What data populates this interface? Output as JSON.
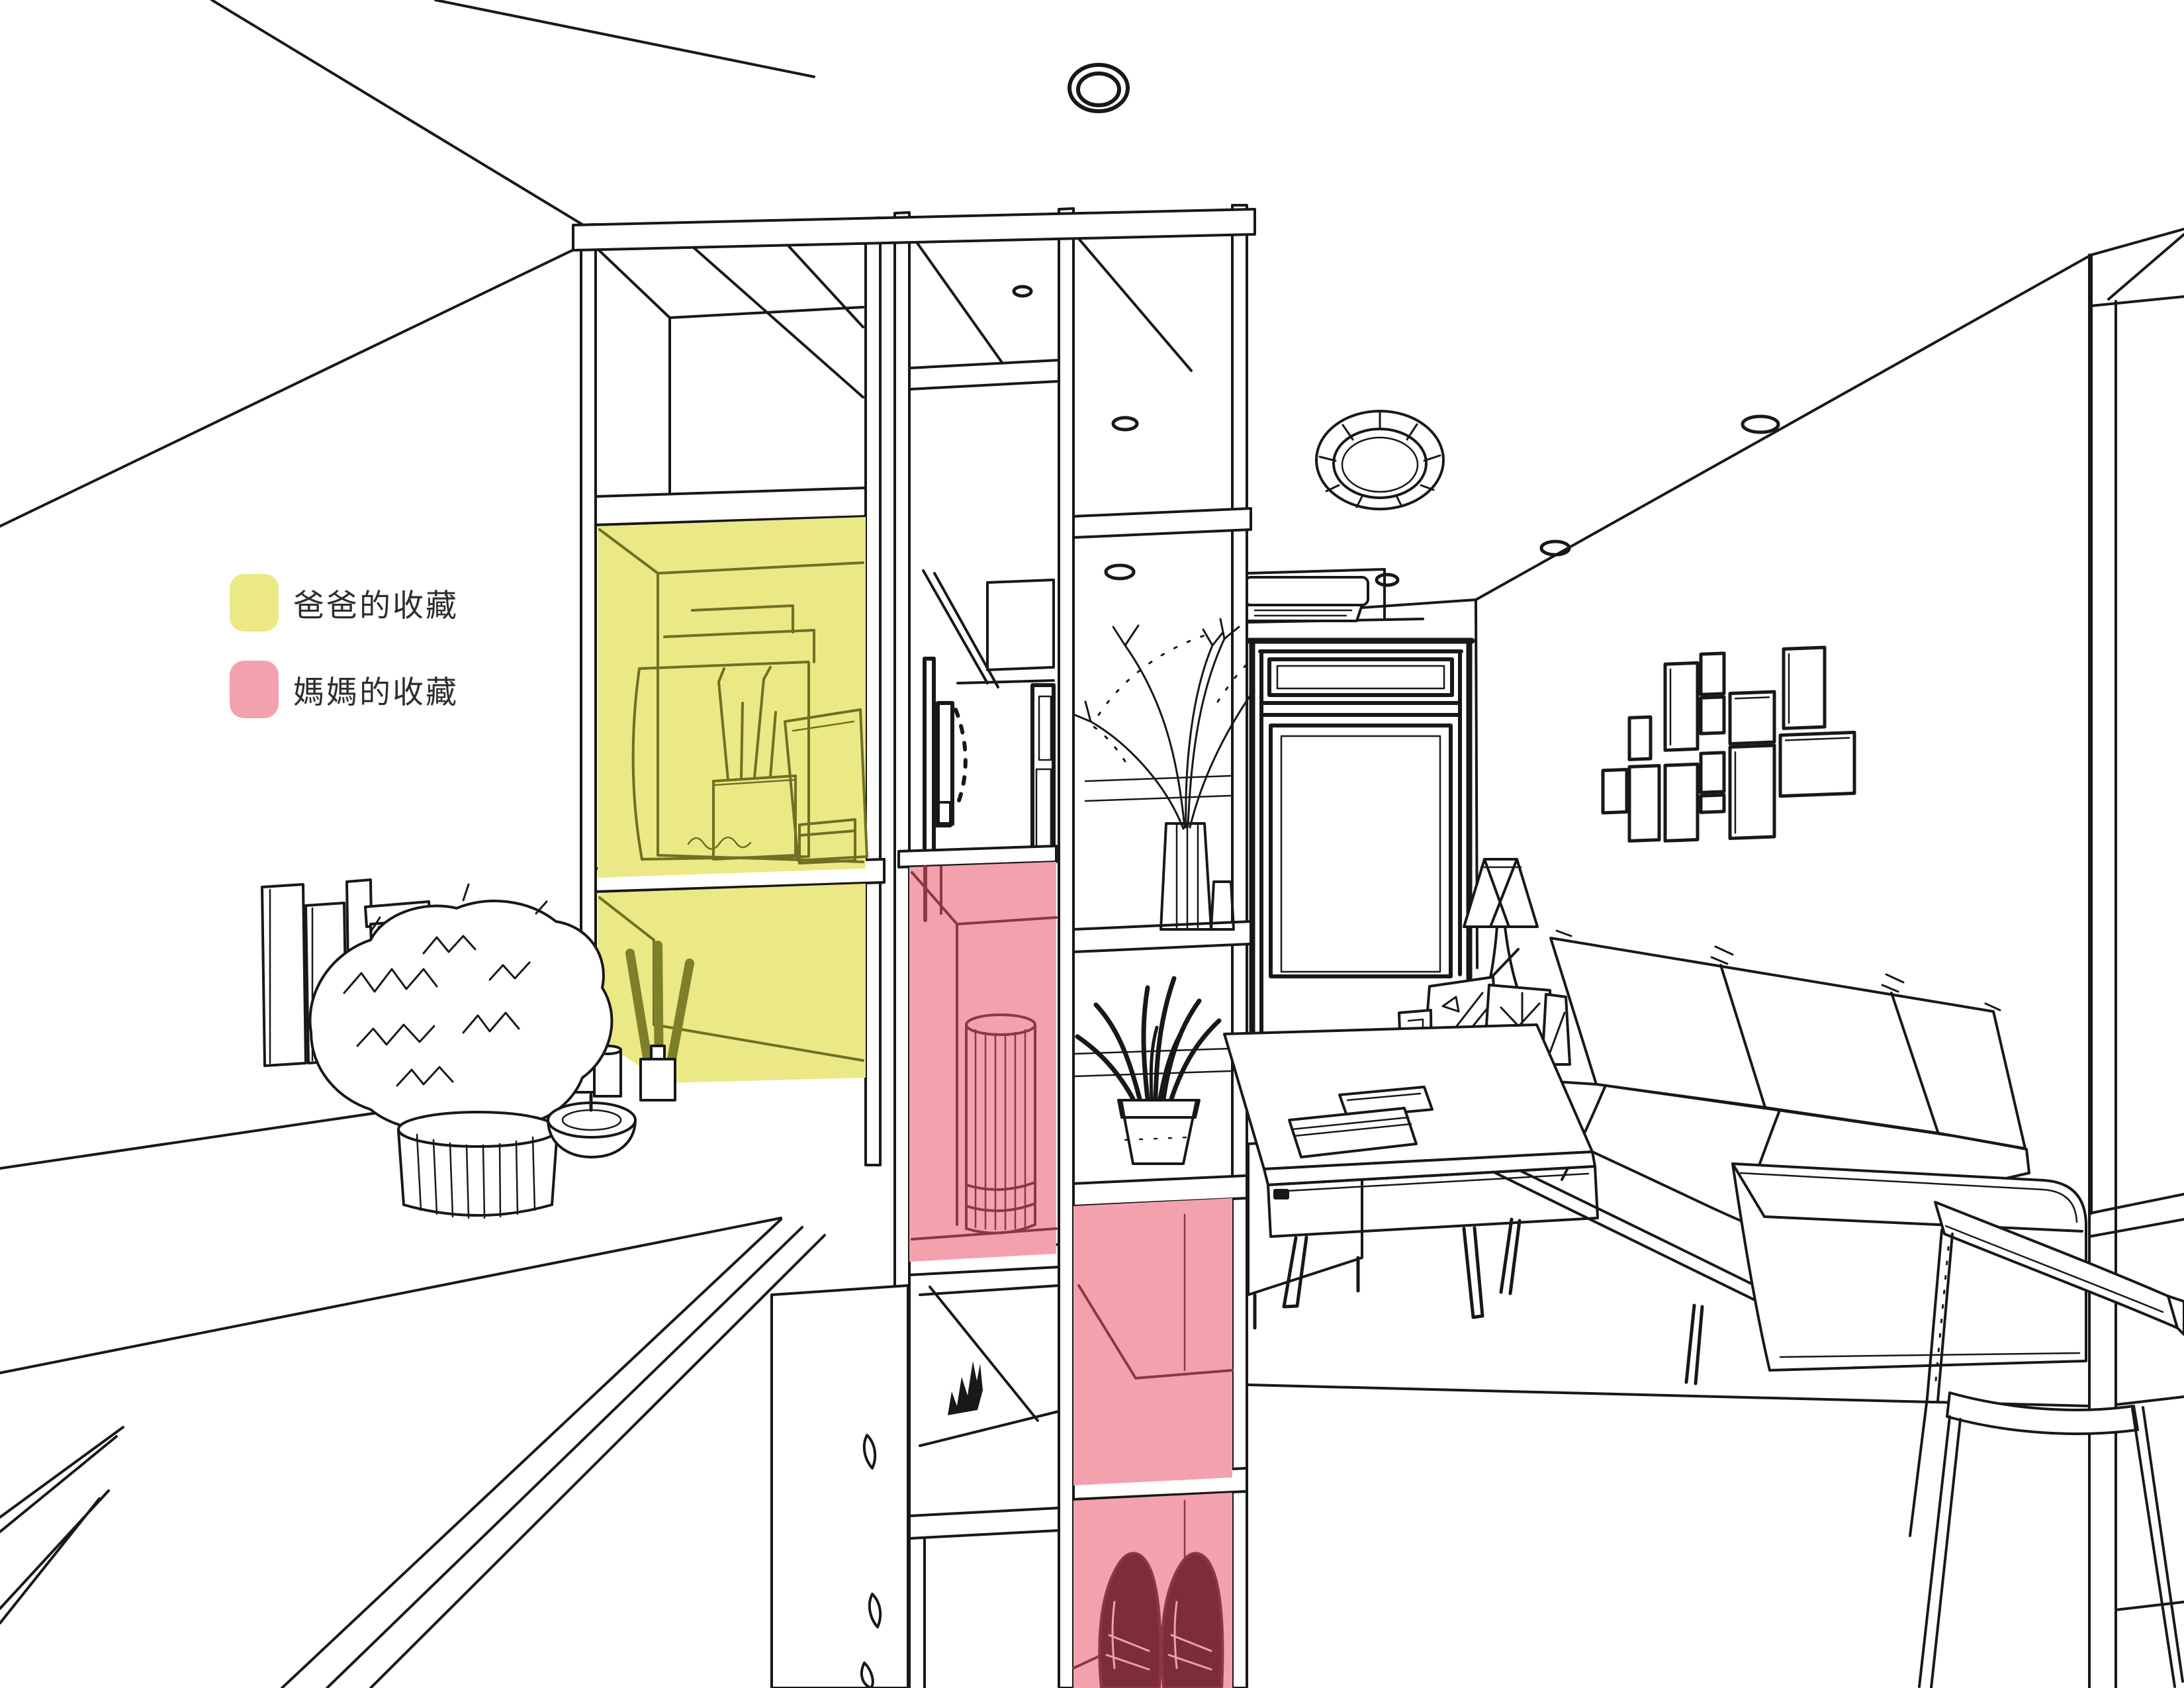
{
  "legend": {
    "items": [
      {
        "label": "爸爸的收藏",
        "zone": "dad-collection",
        "color": "#ebe886"
      },
      {
        "label": "媽媽的收藏",
        "zone": "mom-collection",
        "color": "#f3a2ad"
      }
    ]
  },
  "theme": {
    "background": "#ffffff",
    "line": "#181818",
    "highlight_yellow": "#ebe886",
    "highlight_pink": "#f3a2ad",
    "line_olive": "#6f7022",
    "line_maroon": "#8e3645",
    "shoe_fill": "#7c2d39",
    "shoe_hatch": "#e4a5ae",
    "stick_olive": "#7d7f2a",
    "text": "#2e2e2e"
  }
}
